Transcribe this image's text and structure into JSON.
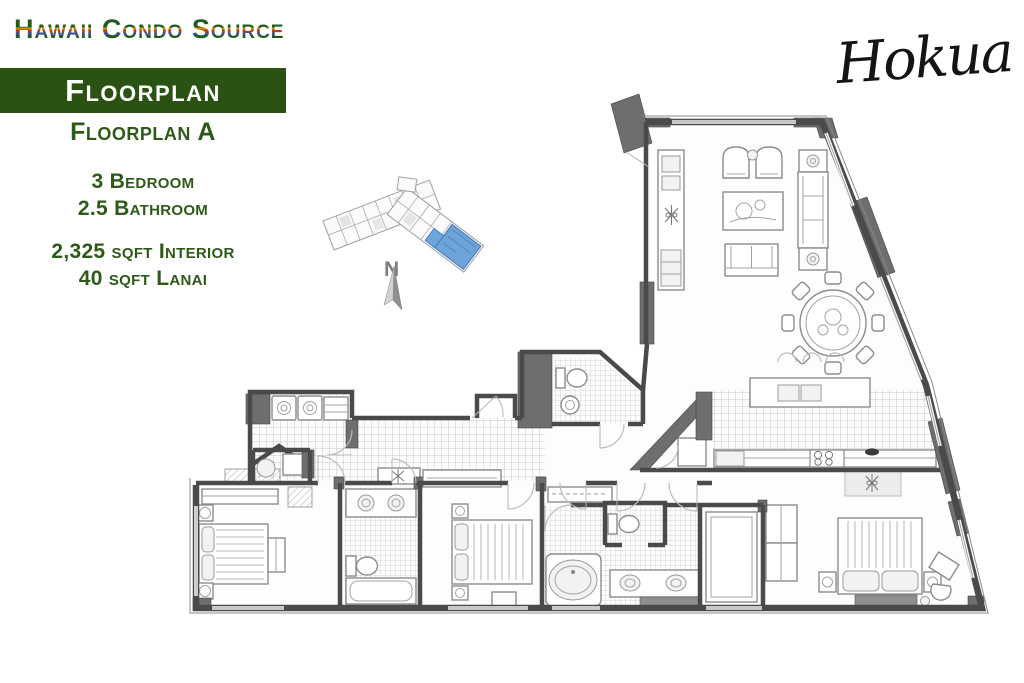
{
  "branding": {
    "site_logo_text": "Hawaii Condo Source",
    "building_logo_text": "Hokua"
  },
  "left_panel": {
    "banner_title": "Floorplan",
    "plan_name": "Floorplan A",
    "bedrooms": "3 Bedroom",
    "bathrooms": "2.5 Bathroom",
    "interior_area": "2,325 sqft Interior",
    "lanai_area": "40 sqft Lanai"
  },
  "compass": {
    "north_label": "N"
  },
  "colors": {
    "banner_green": "#2a5212",
    "text_green": "#2d5a17",
    "unit_blue": "#6ea4da",
    "stripe_green": "#1e5c1e",
    "stripe_yellow": "#c79a00",
    "stripe_red": "#b23a28",
    "stripe_blue": "#31569f",
    "wall": "#4a4a4a"
  }
}
